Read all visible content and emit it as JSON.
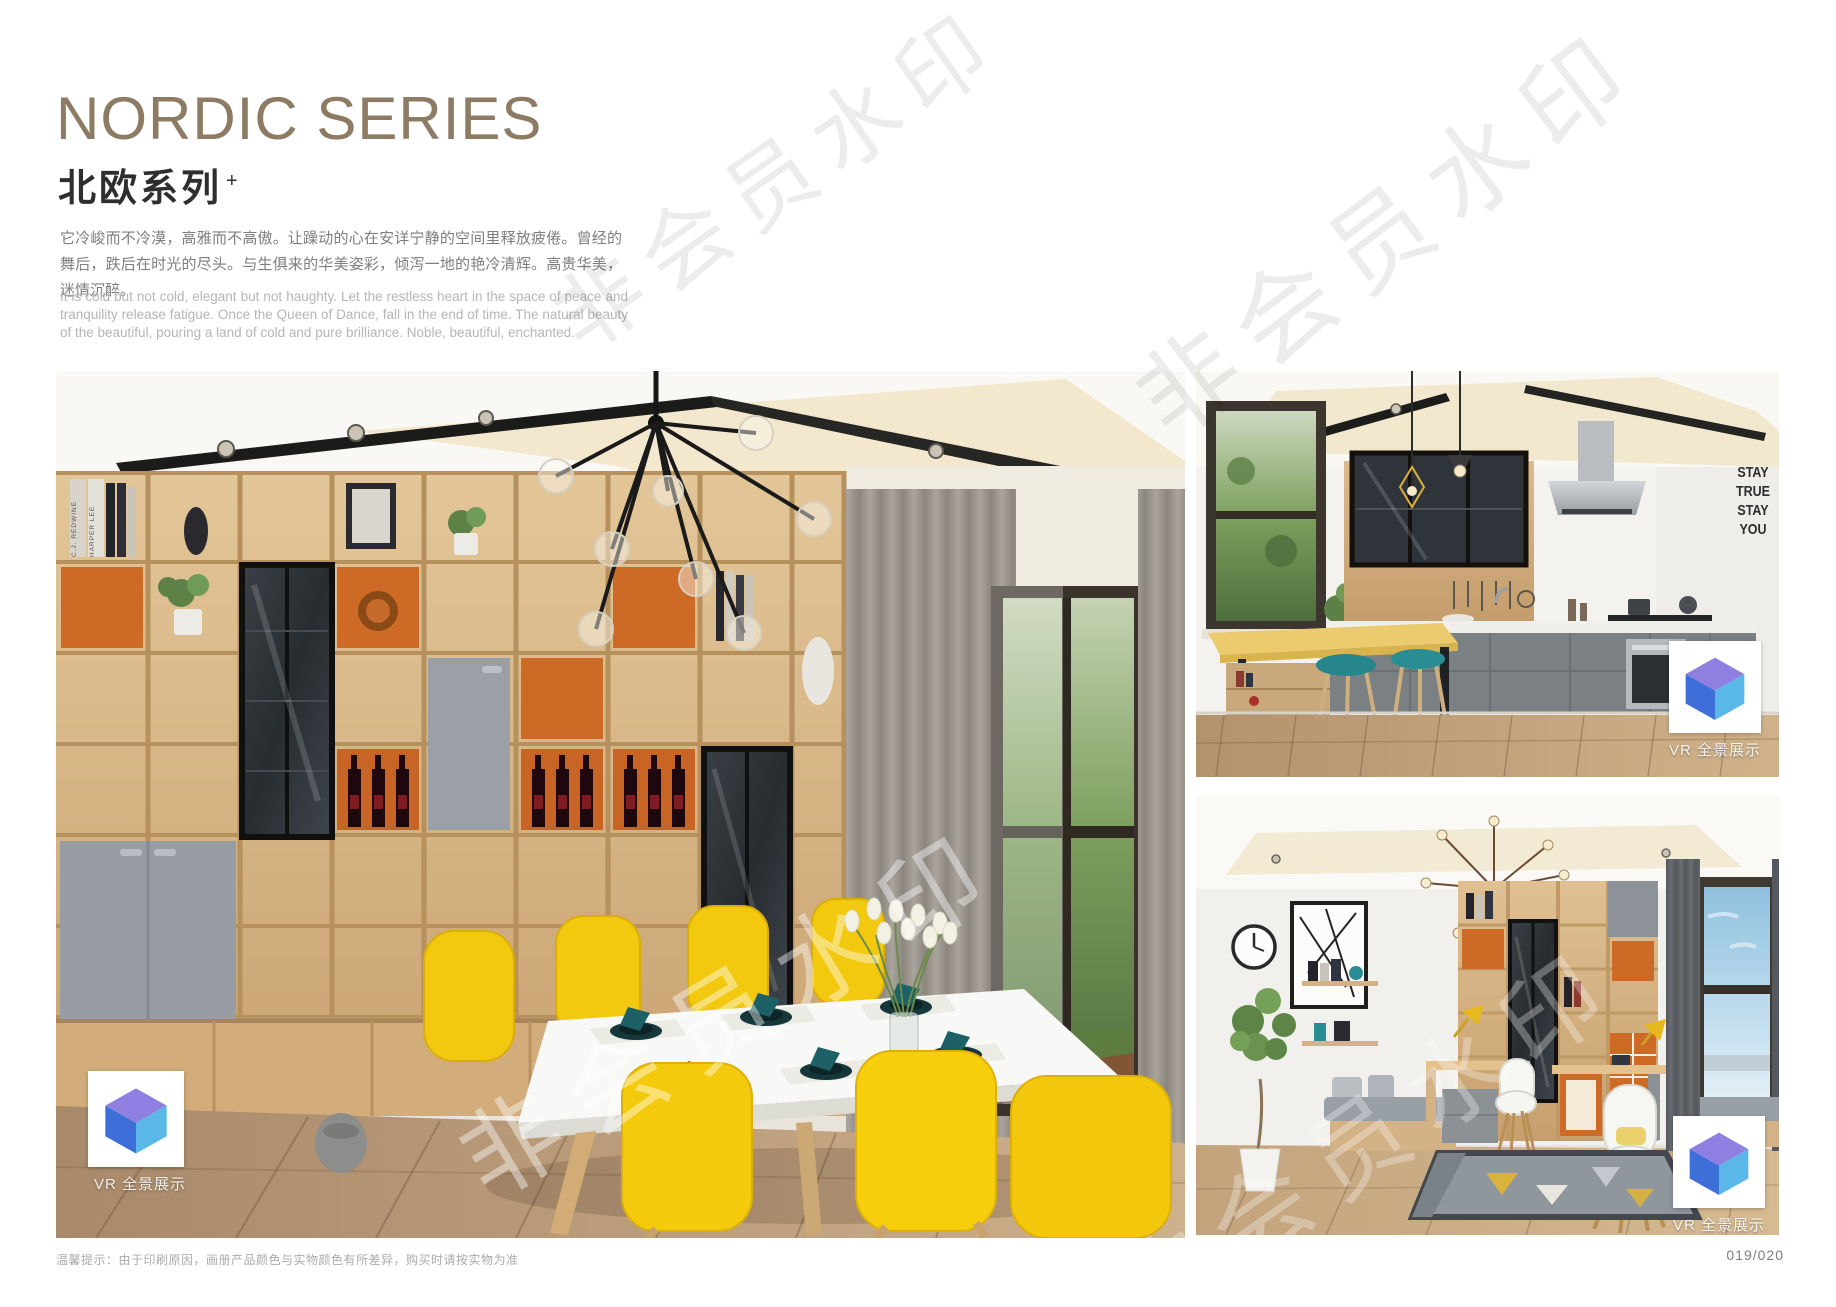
{
  "page": {
    "footer_note": "温馨提示：由于印刷原因，画册产品颜色与实物颜色有所差异，购买时请按实物为准",
    "page_number": "019/020",
    "watermark_text": "非会员水印"
  },
  "header": {
    "title_en": "NORDIC SERIES",
    "title_cn": "北欧系列",
    "title_sup": "+",
    "desc_cn": "它冷峻而不冷漠，高雅而不高傲。让躁动的心在安详宁静的空间里释放疲倦。曾经的舞后，跌后在时光的尽头。与生俱来的华美姿彩，倾泻一地的艳冷清辉。高贵华美，迷情沉醉。",
    "desc_en": "It is cold but not cold, elegant but not haughty. Let the restless heart in the space of peace and tranquility release fatigue. Once the Queen of Dance, fall in the end of time. The natural beauty of the beautiful, pouring a land of cold and pure brilliance. Noble, beautiful, enchanted."
  },
  "photos": {
    "dining": {
      "vr_label": "VR 全景展示",
      "book_spine_1": "C.J. REDWINE",
      "book_spine_2": "HARPER LEE"
    },
    "kitchen": {
      "vr_label": "VR 全景展示",
      "wall_art": [
        "STAY",
        "TRUE",
        "STAY",
        "YOU"
      ]
    },
    "study": {
      "vr_label": "VR 全景展示"
    }
  },
  "colors": {
    "title": "#8d7b64",
    "accent_orange": "#cd6a26",
    "chair_yellow": "#f6ce0b",
    "napkin_teal": "#1d6066",
    "cabinet_gray": "#979da2",
    "wood": "#d7b585",
    "qr_logo_top": "#8f7fe0",
    "qr_logo_left": "#3e6fd9",
    "qr_logo_right": "#59b8e8"
  }
}
